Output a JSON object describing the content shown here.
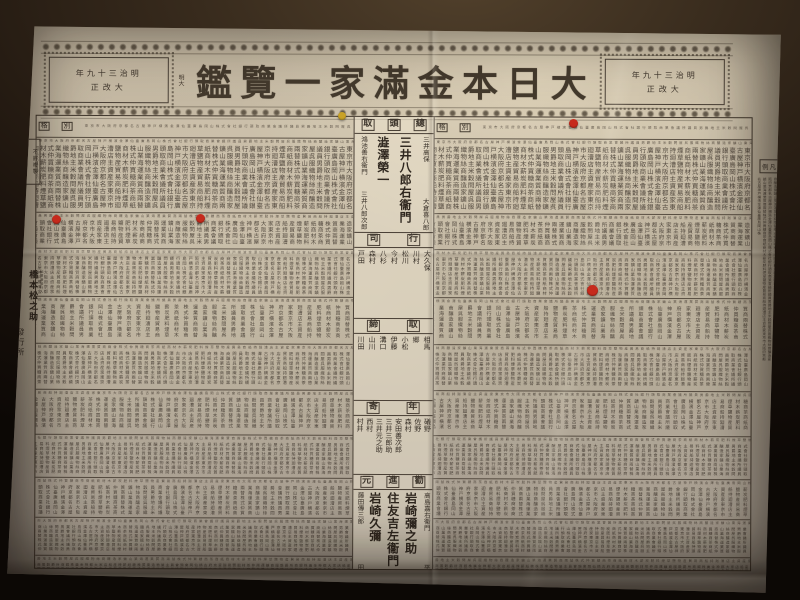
{
  "scene": {
    "wall_color": "#17100b",
    "paper_color": "#b9ad98",
    "ink_color": "#3c342b",
    "accent_red": "#c62a1c",
    "accent_yellow": "#c9a227"
  },
  "header": {
    "era_year": "明治三十九年",
    "era_rev": "大改正",
    "mini_era": "明大",
    "title": "大日本金滿家一覽鑑"
  },
  "table": {
    "rank_label": "別格"
  },
  "center": {
    "top_header": "總頭取",
    "groups": [
      {
        "type": "names",
        "height": 94,
        "right": [
          "三井高保",
          "大倉喜八郎"
        ],
        "big": [
          "三井八郎右衞門",
          "澁澤榮一"
        ],
        "left": [
          "鴻池善右衞門",
          "三井八郎次郎"
        ]
      },
      {
        "type": "bar",
        "label": "行司"
      },
      {
        "type": "row",
        "height": 66,
        "names": [
          "大久保",
          "川村",
          "松川",
          "今村",
          "八杉",
          "森村",
          "戸田"
        ]
      },
      {
        "type": "bar",
        "label": "取締"
      },
      {
        "type": "row",
        "height": 62,
        "names": [
          "相馬",
          "郷",
          "小松",
          "伊藤",
          "溝口",
          "山川",
          "川田"
        ]
      },
      {
        "type": "bar",
        "label": "年寄"
      },
      {
        "type": "row",
        "height": 54,
        "names": [
          "礒野",
          "佐野",
          "森村",
          "安田善次郎",
          "三井三郎助",
          "三井元之助",
          "西村",
          "村井"
        ]
      },
      {
        "type": "bar",
        "label": "勸進元"
      },
      {
        "type": "names",
        "height": 98,
        "right": [
          "高島嘉右衞門",
          "平沼專藏"
        ],
        "big": [
          "岩崎彌之助",
          "住友吉左衞門",
          "岩崎久彌"
        ],
        "left": [
          "藤田傳三郎",
          "田中平八"
        ]
      }
    ]
  },
  "margins": {
    "no_copy": "不許複製",
    "publisher_role": "編纂兼發行人",
    "publisher_name": "橋本松之助",
    "publisher_label": "發行所",
    "store_main": "法令館本店",
    "store_branch": "仝支店",
    "legend_header": "凡例"
  },
  "stickers": [
    {
      "name": "yellow-sticker",
      "x": 342,
      "y": 116,
      "d": 8,
      "color": "#c9a227"
    },
    {
      "name": "red-sticker",
      "x": 573,
      "y": 123,
      "d": 9,
      "color": "#c62a1c"
    },
    {
      "name": "red-sticker",
      "x": 56,
      "y": 219,
      "d": 9,
      "color": "#c62a1c"
    },
    {
      "name": "red-sticker",
      "x": 200,
      "y": 218,
      "d": 9,
      "color": "#c62a1c"
    },
    {
      "name": "red-sticker",
      "x": 592,
      "y": 290,
      "d": 11,
      "color": "#c62a1c"
    }
  ],
  "filler": "東京市大阪府京都名古屋神戸横濱金澤仙臺廣島岡山株式會社銀行頭取商業會議所議員男爵地主米穀問屋呉服織物絲商釀造家鑛山業海運業質商兩替株式仲買糖商茶商紙商材木薪炭肥料煙草鹽物産貿易商船持廻漕店主資産家"
}
